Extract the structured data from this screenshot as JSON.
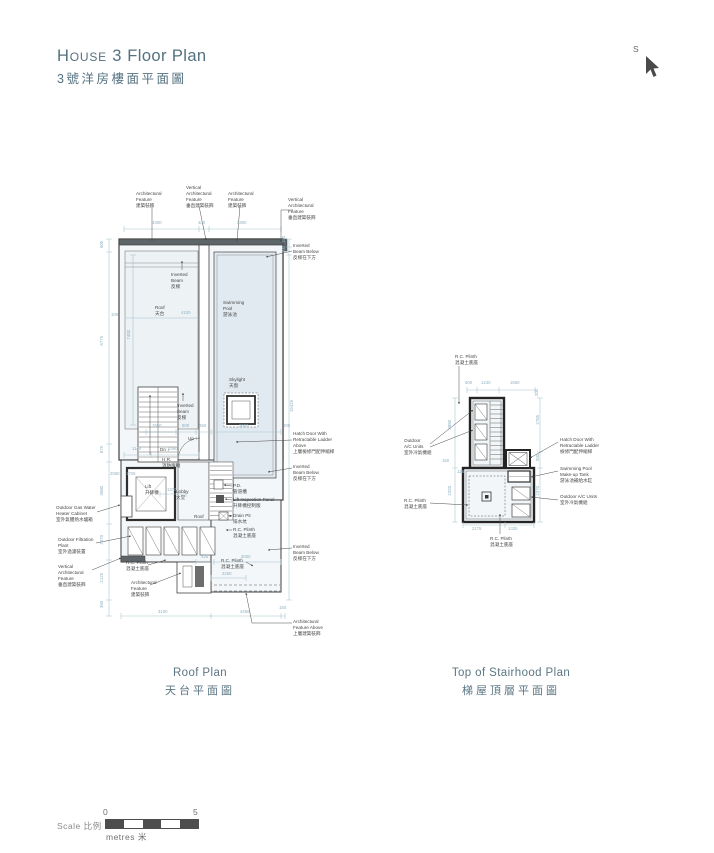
{
  "header": {
    "title_caps": "House 3",
    "title_rest": " Floor Plan",
    "title_zh": "3號洋房樓面平面圖",
    "compass_label": "S"
  },
  "roof_plan": {
    "caption_en": "Roof Plan",
    "caption_zh": "天台平面圖",
    "labels": [
      "Architectural\nFeature\n建築裝飾",
      "Vertical\nArchitectural\nFeature\n垂直建築裝飾",
      "Architectural\nFeature\n建築裝飾",
      "Vertical\nArchitectural\nFeature\n垂直建築裝飾",
      "Inverted\nBeam Below\n反樑在下方",
      "Inverted\nBeam\n反樑",
      "Roof\n天台",
      "Swimming\nPool\n游泳池",
      "Skylight\n天窗",
      "Inverted\nBeam\n反樑",
      "Up ↑",
      "Dn ↓",
      "H.R.\n消防喉轆",
      "Lift\n升降機",
      "Lobby\n大堂",
      "Roof",
      "P.D.\n管道槽",
      "Lift Inspection Panel\n升降機控制版",
      "Drain Pit\n排水坑",
      "R.C. Plinth\n混凝土底座",
      "Hatch Door With\nRetractable Ladder\nAbove\n上層檢修門配伸縮梯",
      "Inverted\nBeam Below\n反樑在下方",
      "Inverted\nBeam Below\n反樑在下方",
      "Outdoor Gas Water\nHeater Cabinet\n室外氣體熱水爐箱",
      "Outdoor Filtration\nPlant\n室外過濾裝置",
      "Vertical\nArchitectural\nFeature\n垂直建築裝飾",
      "R.C. Plinth\n混凝土底座",
      "Architectural\nFeature\n建築裝飾",
      "R.C. Plinth\n混凝土底座",
      "Architectural\nFeature Above\n上層建築裝飾"
    ],
    "dims": [
      "4300",
      "400",
      "2800",
      "600",
      "6775",
      "875",
      "3680",
      "2370",
      "2125",
      "350",
      "150",
      "300",
      "19425",
      "7400",
      "100",
      "4100",
      "1550",
      "800",
      "650",
      "2600",
      "200",
      "1140",
      "2360",
      "2050",
      "1725",
      "1370",
      "425",
      "3000",
      "2250",
      "3100",
      "4250",
      "150"
    ]
  },
  "stairhood_plan": {
    "caption_en": "Top of Stairhood Plan",
    "caption_zh": "梯屋頂層平面圖",
    "labels": [
      "R.C. Plinth\n混凝土底座",
      "Outdoor\nA/C Units\n室外冷氣機組",
      "R.C. Plinth\n混凝土底座",
      "Hatch Door With\nRetractable Ladder\n檢修門配伸縮梯",
      "Swimming Pool\nMake-up Tank\n游泳池補給水缸",
      "Outdoor A/C Units\n室外冷氣機組",
      "R.C. Plinth\n混凝土底座"
    ],
    "dims": [
      "600",
      "1240",
      "1560",
      "200",
      "2785",
      "500",
      "2370",
      "3880",
      "2320",
      "150",
      "125",
      "2175",
      "1325"
    ]
  },
  "scale_bar": {
    "label": "Scale 比例",
    "start": "0",
    "end": "5",
    "unit": "metres 米"
  }
}
